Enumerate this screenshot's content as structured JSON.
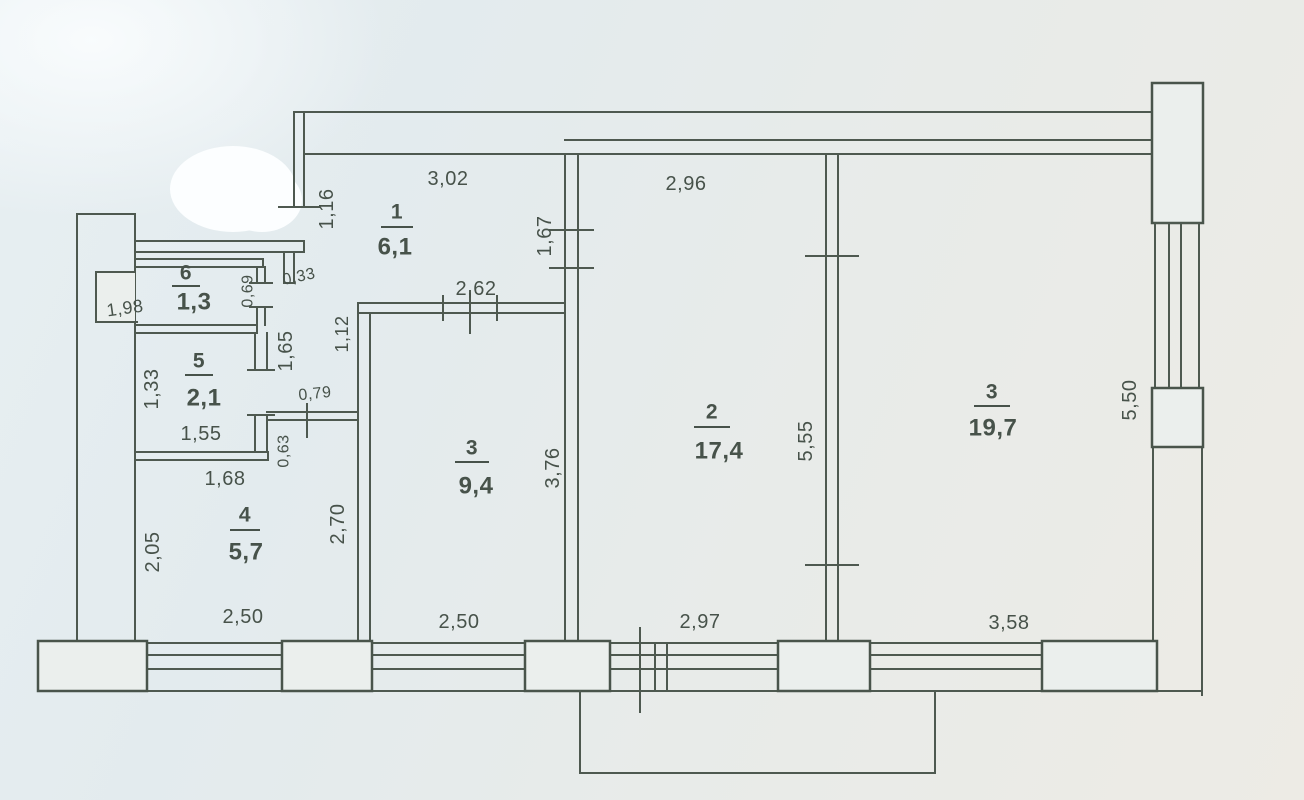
{
  "rooms": [
    {
      "number": "1",
      "area": "6,1"
    },
    {
      "number": "6",
      "area": "1,3"
    },
    {
      "number": "5",
      "area": "2,1"
    },
    {
      "number": "4",
      "area": "5,7"
    },
    {
      "number": "3",
      "area": "9,4"
    },
    {
      "number": "2",
      "area": "17,4"
    },
    {
      "number": "3",
      "area": "19,7"
    }
  ],
  "dimensions": {
    "hall_top": "3,02",
    "room2_top": "2,96",
    "hall_left": "1,16",
    "hall_right": "1,67",
    "room3a_top": "2,62",
    "wall_gap": "0,33",
    "room6_height": "0,69",
    "room6_width": "1,98",
    "room5_left": "1,33",
    "room5_width": "1,55",
    "corridor_left": "1,65",
    "room3a_left_upper": "1,12",
    "corridor_door": "0,79",
    "corridor_stub": "0,63",
    "room5_bottom": "1,68",
    "room4_left": "2,05",
    "room4_right": "2,70",
    "room3a_right": "3,76",
    "room2_right": "5,55",
    "room3b_right": "5,50",
    "room3b_bottom": "3,58",
    "window_a": "2,50",
    "window_b": "2,50",
    "balcony_window": "2,97"
  },
  "colors": {
    "ink": "#4e5950",
    "paper": "#e8ecea",
    "erasure": "#fcfeff"
  }
}
